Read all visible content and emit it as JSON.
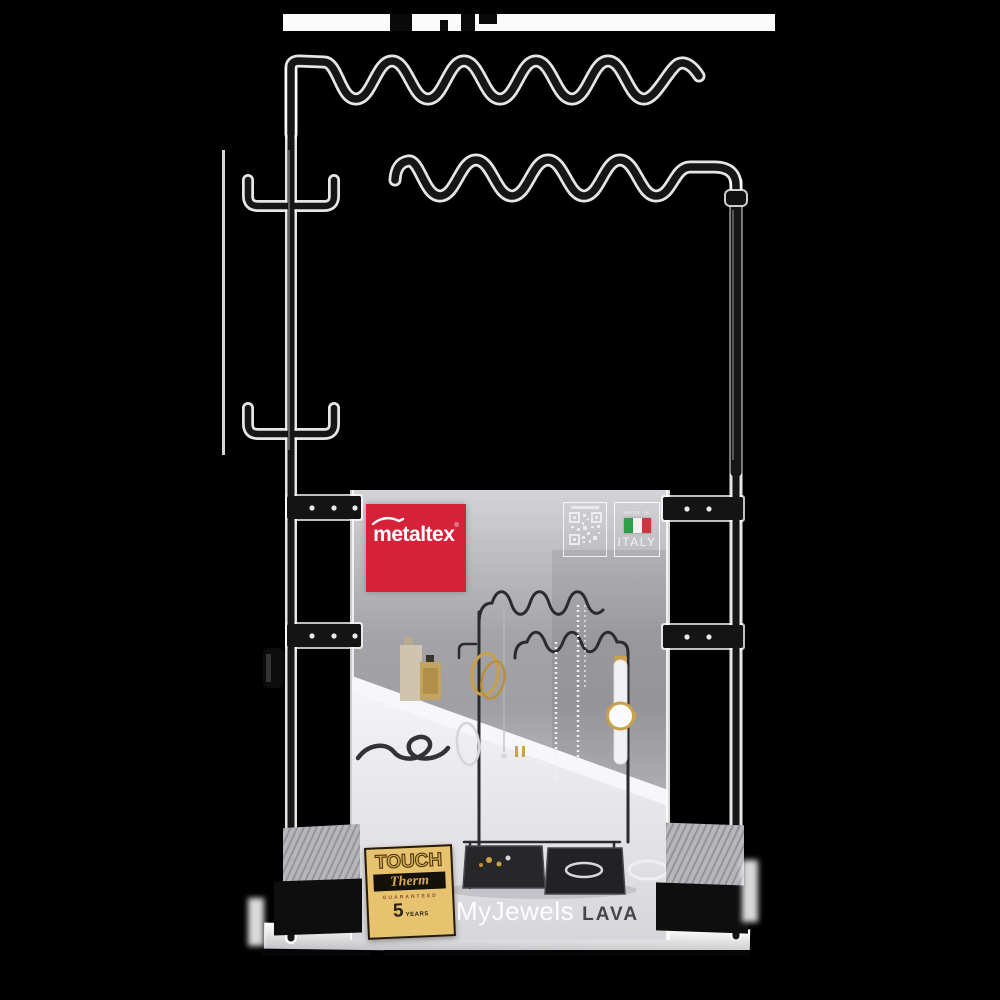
{
  "product": {
    "brand": "metaltex",
    "brand_mark": "®",
    "name": "MyJewels",
    "variant": "LAVA",
    "made_in": {
      "line1": "MADE IN",
      "line2": "ITALY"
    },
    "badge": {
      "touch": "TOUCH",
      "therm": "Therm",
      "guaranteed": "GUARANTEED",
      "years_number": "5",
      "years_label": "YEARS"
    }
  },
  "icons": {
    "logo_roof": "roof-icon",
    "qr": "qr-code-icon",
    "flag": "italy-flag-icon"
  },
  "colors": {
    "background": "#000000",
    "brand_red": "#d52239",
    "badge_gold": "#e7c370",
    "flag_green": "#2f9e49",
    "flag_red": "#cf3441",
    "rack_black": "#161616",
    "card_gray": "#c3c2c7"
  }
}
